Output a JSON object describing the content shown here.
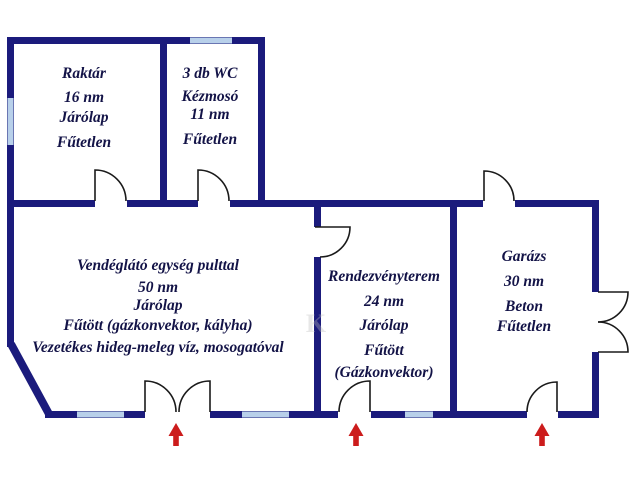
{
  "colors": {
    "wall": "#1b1b7c",
    "window": "#b8d0ea",
    "door": "#1a1a1a",
    "text": "#131347",
    "arrow": "#cc1c1c",
    "background": "#ffffff",
    "watermark": "#bdbdbd"
  },
  "rooms": [
    {
      "id": "raktar",
      "lines": [
        "Raktár",
        "16 nm",
        "Járólap",
        "Fűtetlen"
      ]
    },
    {
      "id": "wc",
      "lines": [
        "3 db WC",
        "Kézmosó",
        "11 nm",
        "Fűtetlen"
      ]
    },
    {
      "id": "vendeglato",
      "lines": [
        "Vendéglátó egység pulttal",
        "50 nm",
        "Járólap",
        "Fűtött (gázkonvektor, kályha)",
        "Vezetékes hideg-meleg víz, mosogatóval"
      ]
    },
    {
      "id": "rendezvenyterem",
      "lines": [
        "Rendezvényterem",
        "24 nm",
        "Járólap",
        "Fűtött",
        "(Gázkonvektor)"
      ]
    },
    {
      "id": "garazs",
      "lines": [
        "Garázs",
        "30 nm",
        "Beton",
        "Fűtetlen"
      ]
    }
  ],
  "entrance_arrow_count": 3,
  "watermark": "K"
}
